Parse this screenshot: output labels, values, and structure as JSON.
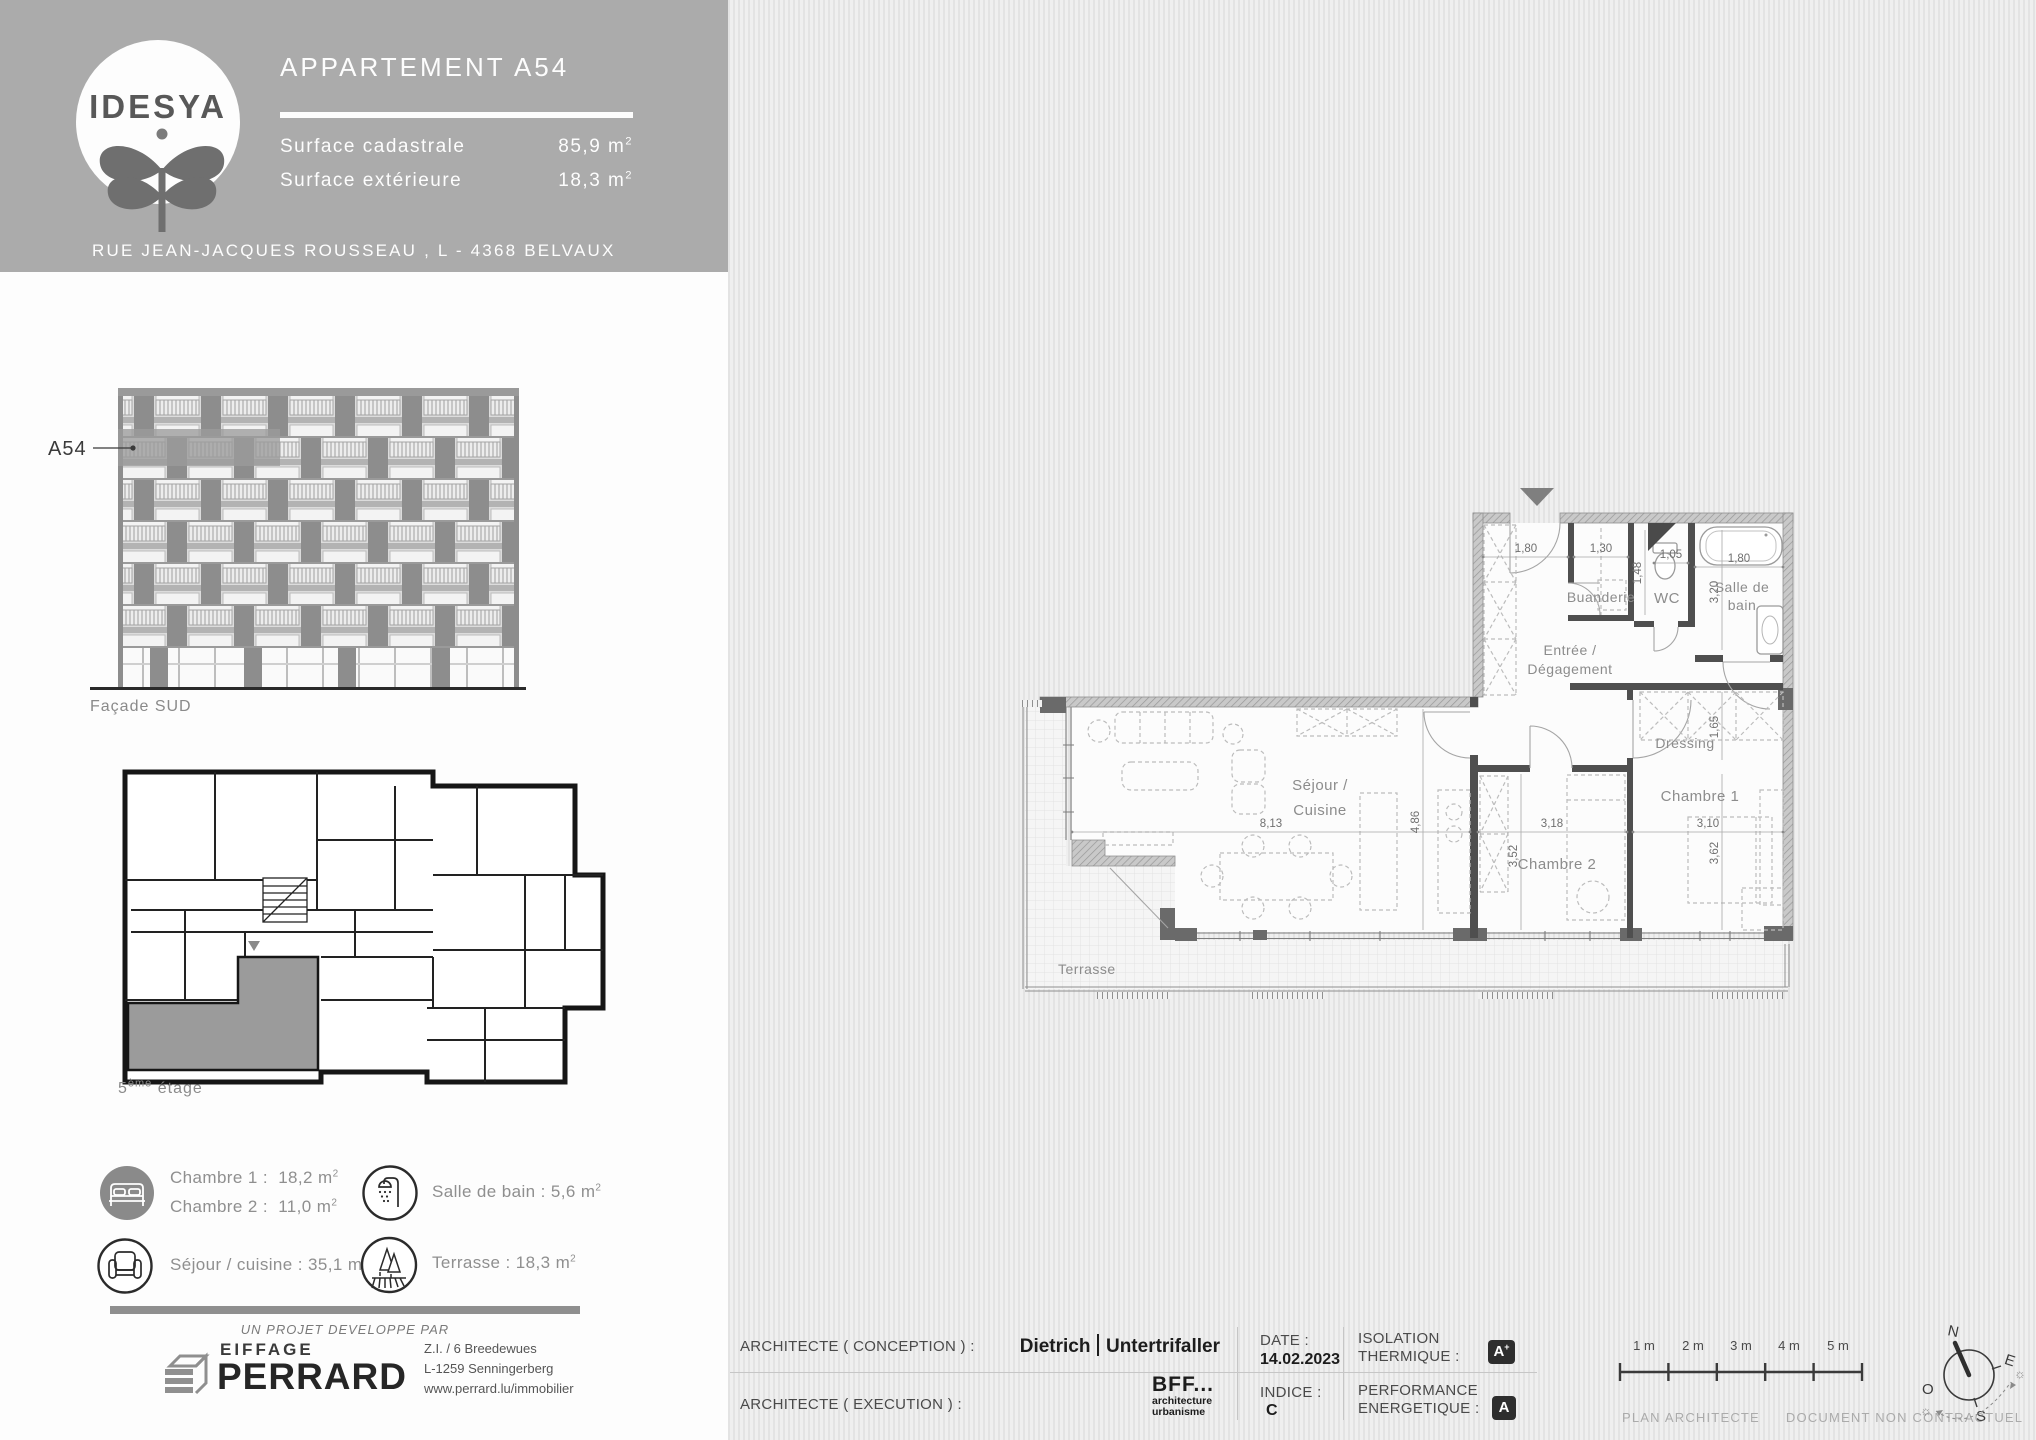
{
  "colors": {
    "header_gray": "#ABABAB",
    "badge_dark": "#2E2E2E",
    "unit_highlight": "#9B9B9B"
  },
  "header": {
    "logo_text": "IDESYA",
    "title": "APPARTEMENT A54",
    "rows": [
      {
        "label": "Surface cadastrale",
        "value": "85,9",
        "unit": "m",
        "exp": "2"
      },
      {
        "label": "Surface extérieure",
        "value": "18,3",
        "unit": "m",
        "exp": "2"
      }
    ],
    "address": "RUE JEAN-JACQUES ROUSSEAU , L - 4368 BELVAUX"
  },
  "facade": {
    "unit_label": "A54",
    "caption": "Façade SUD"
  },
  "key_plan": {
    "floor_num": "5",
    "floor_sup": "ème",
    "floor_word": "étage"
  },
  "legend": {
    "items": [
      {
        "icon": "bed-icon",
        "lines": [
          {
            "label": "Chambre 1 :",
            "value": "18,2",
            "unit": "m",
            "exp": "2"
          },
          {
            "label": "Chambre 2 :",
            "value": "11,0",
            "unit": "m",
            "exp": "2"
          }
        ]
      },
      {
        "icon": "shower-icon",
        "lines": [
          {
            "label": "Salle de bain :",
            "value": "5,6",
            "unit": "m",
            "exp": "2"
          }
        ]
      },
      {
        "icon": "sofa-icon",
        "lines": [
          {
            "label": "Séjour / cuisine :",
            "value": "35,1",
            "unit": "m",
            "exp": "2"
          }
        ]
      },
      {
        "icon": "trees-icon",
        "lines": [
          {
            "label": "Terrasse :",
            "value": "18,3",
            "unit": "m",
            "exp": "2"
          }
        ]
      }
    ]
  },
  "developer": {
    "tagline": "UN PROJET DEVELOPPE PAR",
    "brand_top": "EIFFAGE",
    "brand_main": "PERRARD",
    "address_lines": [
      "Z.I. / 6 Breedewues",
      "L-1259 Senningerberg",
      "www.perrard.lu/immobilier"
    ]
  },
  "plan": {
    "rooms": {
      "sejour_1": "Séjour /",
      "sejour_2": "Cuisine",
      "buanderie": "Buanderie",
      "wc": "WC",
      "sdb_1": "Salle de",
      "sdb_2": "bain",
      "entree_1": "Entrée /",
      "entree_2": "Dégagement",
      "dressing": "Dressing",
      "chambre1": "Chambre 1",
      "chambre2": "Chambre 2",
      "terrasse": "Terrasse"
    },
    "dims": {
      "entree_w": "1,80",
      "buanderie_w": "1,30",
      "wc_w": "1,05",
      "wc_h": "1,48",
      "sdb_w": "1,80",
      "sdb_h": "3,20",
      "dressing_h": "1,65",
      "sejour_w": "8,13",
      "sejour_h": "4,86",
      "ch2_w": "3,18",
      "ch2_h": "3,52",
      "ch1_w": "3,10",
      "ch1_h": "3,62"
    }
  },
  "titleblock": {
    "conception_label": "ARCHITECTE ( CONCEPTION ) :",
    "conception_name_1": "Dietrich",
    "conception_name_2": "Untertrifaller",
    "execution_label": "ARCHITECTE ( EXECUTION ) :",
    "execution_brand": "BFF...",
    "execution_sub_1": "architecture",
    "execution_sub_2": "urbanisme",
    "date_label": "DATE :",
    "date_value": "14.02.2023",
    "indice_label": "INDICE :",
    "indice_value": "C",
    "isolation_label_1": "ISOLATION",
    "isolation_label_2": "THERMIQUE :",
    "isolation_grade": "A",
    "isolation_grade_sup": "+",
    "performance_label_1": "PERFORMANCE",
    "performance_label_2": "ENERGETIQUE :",
    "performance_grade": "A",
    "scale_labels": [
      "1 m",
      "2 m",
      "3 m",
      "4 m",
      "5 m"
    ],
    "footnote_1": "PLAN ARCHITECTE",
    "footnote_2": "DOCUMENT NON CONTRACTUEL",
    "compass": {
      "n": "N",
      "e": "E",
      "s": "S",
      "o": "O"
    }
  }
}
